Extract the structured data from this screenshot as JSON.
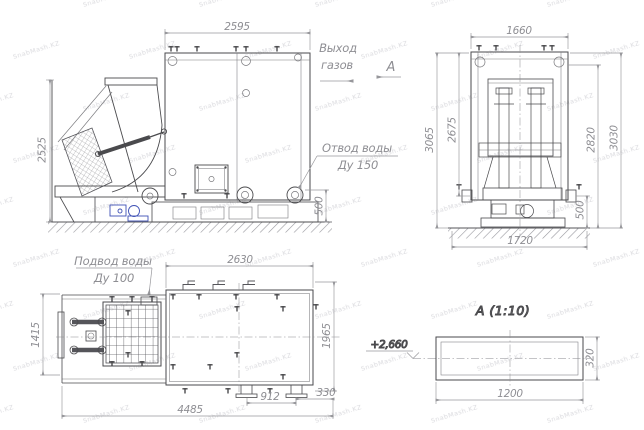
{
  "drawing": {
    "watermark": "SnabMash.KZ",
    "labels": {
      "gas_outlet_1": "Выход",
      "gas_outlet_2": "газов",
      "section_arrow_mark": "А",
      "water_drain_1": "Отвод воды",
      "water_drain_2": "Ду 150",
      "water_supply_1": "Подвод воды",
      "water_supply_2": "Ду 100",
      "section_title": "А  (1:10)",
      "elevation": "+2,660"
    },
    "dims": {
      "side": {
        "width": "2595",
        "height": "2525",
        "base": "500"
      },
      "front": {
        "width": "1660",
        "h_overall": "3065",
        "h_inner": "2675",
        "h_right_inner": "2820",
        "h_right_outer": "3030",
        "base_w": "1720",
        "base_h": "500"
      },
      "plan": {
        "body_w": "2630",
        "left_d": "1415",
        "right_d": "1965",
        "total": "4485",
        "feet": "912",
        "edge": "330"
      },
      "section": {
        "w": "1200",
        "h": "320"
      }
    },
    "colors": {
      "line": "#4a4a4d",
      "thin": "#7a7a7e",
      "dim": "#97979b",
      "text": "#8e8e93",
      "accent_blue": "#3f51b5"
    }
  }
}
